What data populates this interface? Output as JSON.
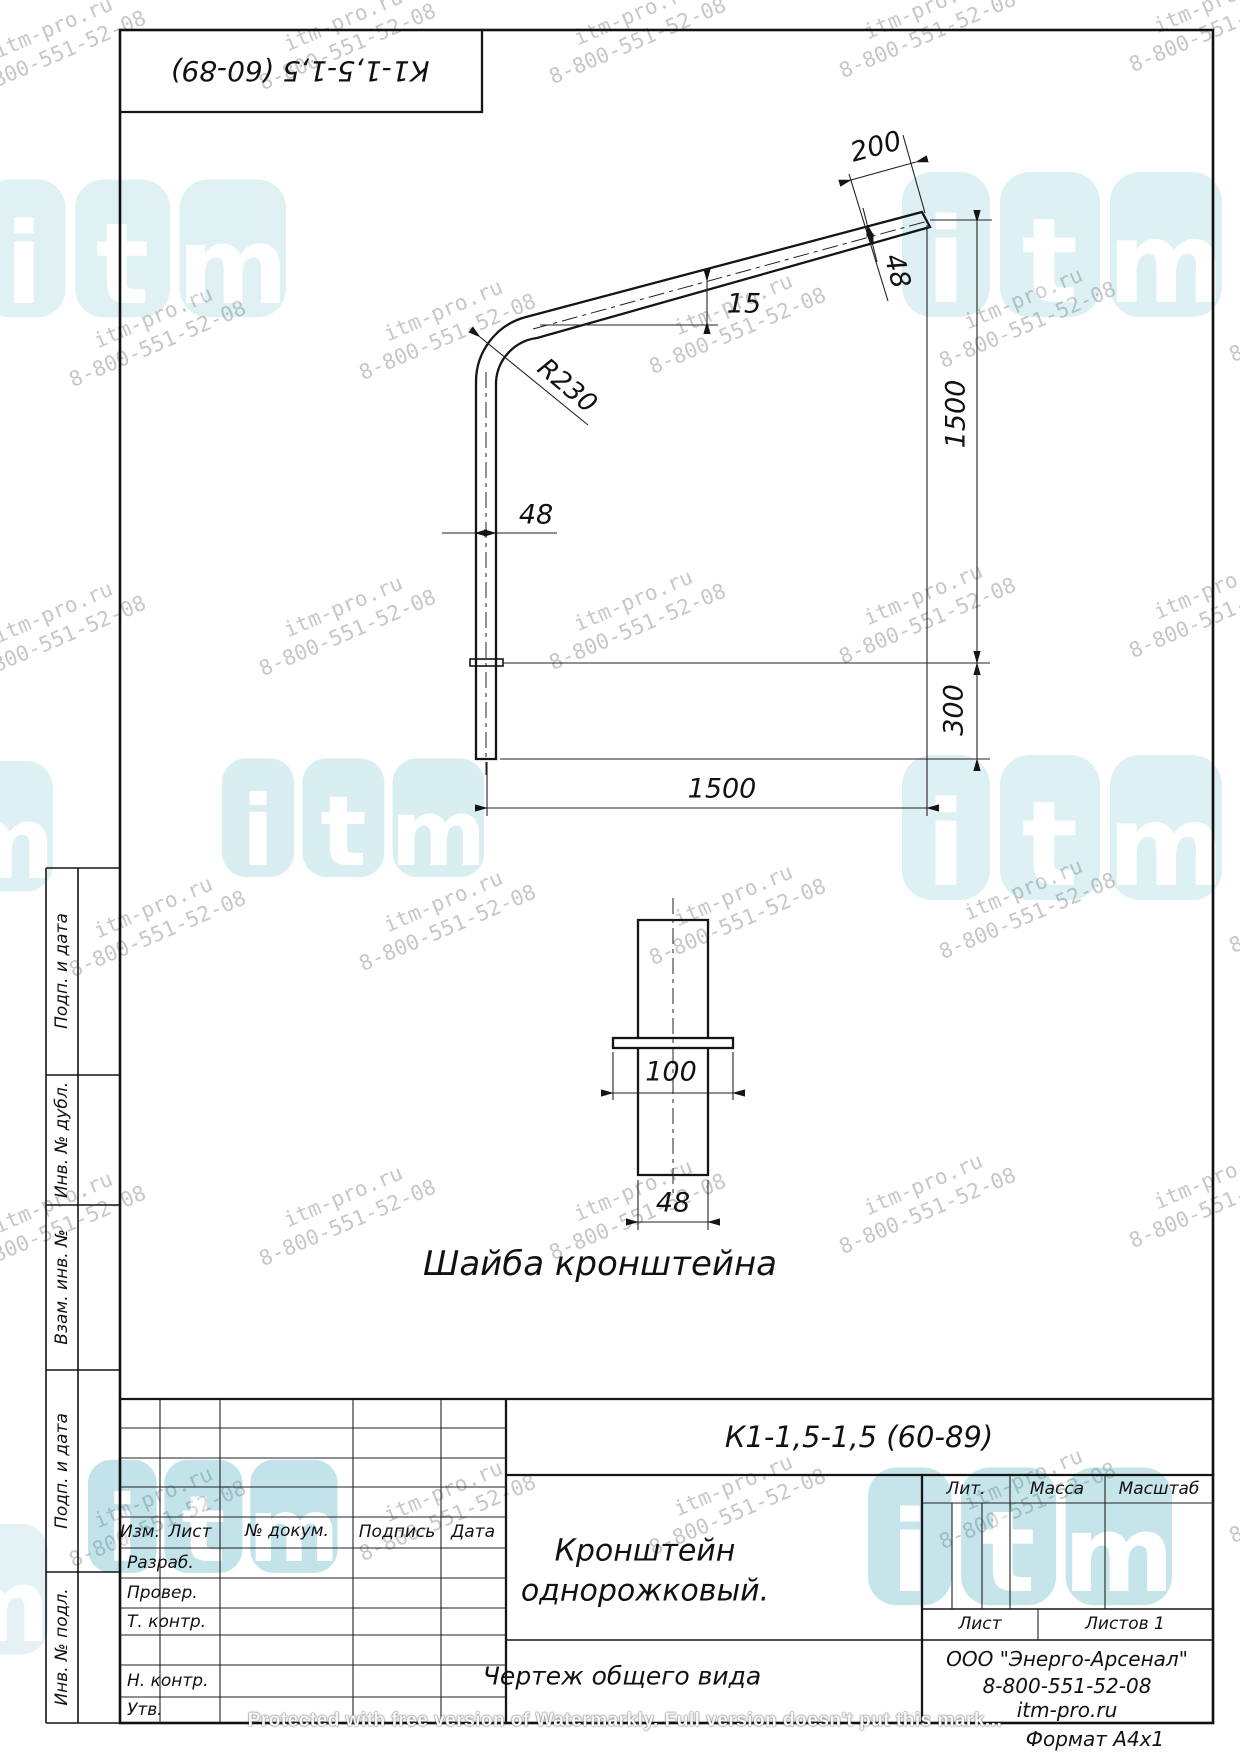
{
  "designation": "К1-1,5-1,5 (60-89)",
  "main_view": {
    "dim_200": "200",
    "dim_48_top": "48",
    "angle_15": "15",
    "radius": "R230",
    "dim_48_left": "48",
    "dim_1500_vertical": "1500",
    "dim_300": "300",
    "dim_1500_horizontal": "1500"
  },
  "washer_view": {
    "dim_100": "100",
    "dim_48": "48",
    "caption": "Шайба кронштейна"
  },
  "margin": {
    "labels": [
      "Подп. и дата",
      "Инв. № дубл.",
      "Взам. инв. №",
      "Подп. и дата",
      "Инв. № подл."
    ]
  },
  "title_block": {
    "revision_headers": [
      "Изм.",
      "Лист",
      "№ докум.",
      "Подпись",
      "Дата"
    ],
    "row_labels": [
      "Разраб.",
      "Провер.",
      "Т. контр.",
      "Н. контр.",
      "Утв."
    ],
    "product_name_line1": "Кронштейн",
    "product_name_line2": "однорожковый.",
    "doc_type": "Чертеж общего вида",
    "lit_label": "Лит.",
    "mass_label": "Масса",
    "scale_label": "Масштаб",
    "sheet_label": "Лист",
    "sheets_label": "Листов 1",
    "company": "ООО \"Энерго-Арсенал\"",
    "phone": "8-800-551-52-08",
    "website": "itm-pro.ru",
    "format_note": "Формат А4х1"
  },
  "watermark": {
    "line1": "itm-pro.ru",
    "line2": "8-800-551-52-08",
    "text_positions": [
      [
        -45,
        55
      ],
      [
        245,
        48
      ],
      [
        535,
        42
      ],
      [
        825,
        36
      ],
      [
        1115,
        30
      ],
      [
        55,
        345
      ],
      [
        345,
        338
      ],
      [
        635,
        332
      ],
      [
        925,
        326
      ],
      [
        1215,
        320
      ],
      [
        -45,
        640
      ],
      [
        245,
        634
      ],
      [
        535,
        628
      ],
      [
        825,
        622
      ],
      [
        1115,
        616
      ],
      [
        55,
        935
      ],
      [
        345,
        929
      ],
      [
        635,
        923
      ],
      [
        925,
        917
      ],
      [
        1215,
        911
      ],
      [
        -45,
        1230
      ],
      [
        245,
        1224
      ],
      [
        535,
        1218
      ],
      [
        825,
        1212
      ],
      [
        1115,
        1206
      ],
      [
        55,
        1525
      ],
      [
        345,
        1519
      ],
      [
        635,
        1513
      ],
      [
        925,
        1507
      ],
      [
        1215,
        1501
      ]
    ],
    "logos": [
      {
        "x": -18,
        "y": 170,
        "s": 0.95,
        "o": 0.15
      },
      {
        "x": 902,
        "y": 162,
        "s": 1.0,
        "o": 0.16
      },
      {
        "x": 222,
        "y": 750,
        "s": 0.82,
        "o": 0.18
      },
      {
        "x": 902,
        "y": 745,
        "s": 1.0,
        "o": 0.16
      },
      {
        "x": -235,
        "y": 752,
        "s": 0.9,
        "o": 0.16
      },
      {
        "x": 88,
        "y": 1452,
        "s": 0.78,
        "o": 0.3
      },
      {
        "x": 868,
        "y": 1458,
        "s": 0.95,
        "o": 0.28
      },
      {
        "x": -240,
        "y": 1515,
        "s": 0.9,
        "o": 0.13
      }
    ]
  },
  "protected_notice": "Protected with free version of Watermarkly. Full version doesn't put this mark..."
}
